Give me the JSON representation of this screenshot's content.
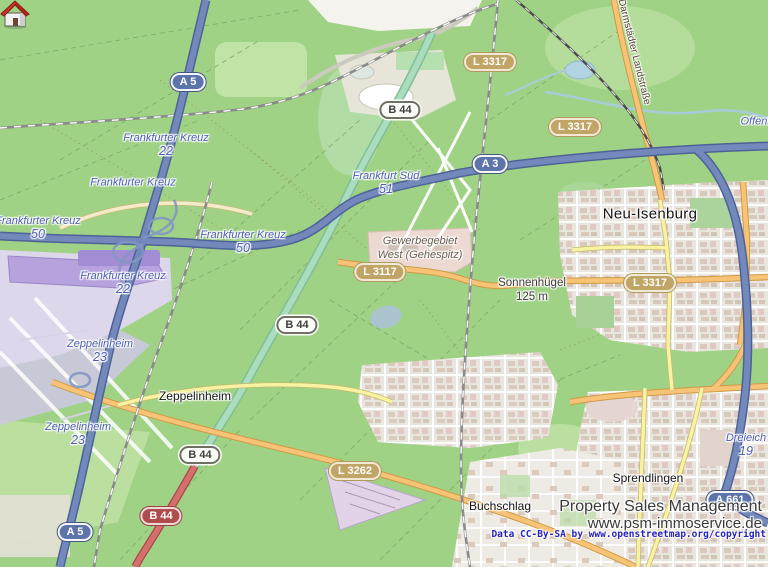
{
  "attribution": {
    "line1": "Property Sales Management",
    "line2": "www.psm-immoservice.de",
    "line3": "Data CC-By-SA by www.openstreetmap.org/copyright"
  },
  "towns": [
    {
      "name": "Neu-Isenburg"
    },
    {
      "name": "Zeppelinheim"
    },
    {
      "name": "Sprendlingen"
    },
    {
      "name": "Buchschlag"
    }
  ],
  "junction_labels": [
    {
      "name": "Frankfurter Kreuz",
      "number": "22"
    },
    {
      "name": "Frankfurter Kreuz",
      "number": ""
    },
    {
      "name": "Frankfurter Kreuz",
      "number": "50"
    },
    {
      "name": "Frankfurter Kreuz",
      "number": "50"
    },
    {
      "name": "Frankfurter Kreuz",
      "number": "22"
    },
    {
      "name": "Frankfurt Süd",
      "number": "51"
    },
    {
      "name": "Zeppelinheim",
      "number": "23"
    },
    {
      "name": "Zeppelinheim",
      "number": "23"
    },
    {
      "name": "Dreieich",
      "number": "19"
    },
    {
      "name": "Offenb",
      "number": ""
    }
  ],
  "road_badges": [
    {
      "ref": "A 5",
      "type": "motorway"
    },
    {
      "ref": "A 3",
      "type": "motorway"
    },
    {
      "ref": "A 5",
      "type": "motorway"
    },
    {
      "ref": "A 661",
      "type": "motorway"
    },
    {
      "ref": "B 44",
      "type": "federal"
    },
    {
      "ref": "B 44",
      "type": "federal"
    },
    {
      "ref": "B 44",
      "type": "federal"
    },
    {
      "ref": "B 44",
      "type": "federal-red"
    },
    {
      "ref": "L 3317",
      "type": "state"
    },
    {
      "ref": "L 3317",
      "type": "state"
    },
    {
      "ref": "L 3117",
      "type": "state"
    },
    {
      "ref": "L 3317",
      "type": "state"
    },
    {
      "ref": "L 3262",
      "type": "state"
    }
  ],
  "area_labels": {
    "industrial": {
      "line1": "Gewerbegebiet",
      "line2": "West (Gehespitz)"
    },
    "hill": {
      "name": "Sonnenhügel",
      "elevation": "125 m"
    }
  },
  "street_labels": {
    "darmstaedter": "Darmstädter Landstraße"
  },
  "marker": {
    "kind": "house",
    "roof_color": "#cf3425"
  },
  "colors": {
    "forest": "#a0d286",
    "motorway": "#7389bb",
    "secondary_road": "#f7c377",
    "primary_road": "#d4706b",
    "state_badge": "#c0a567",
    "junction_text": "#4a5db2"
  }
}
